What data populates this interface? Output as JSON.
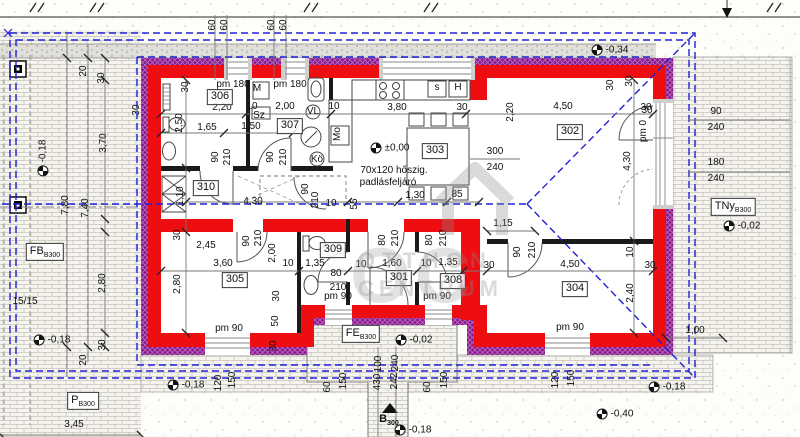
{
  "title": "Családi ház alaprajz (floor plan)",
  "colors": {
    "red": "#ee0d10",
    "insul": "#8a1690",
    "blue": "#2121d8",
    "black": "#1a1a1a",
    "dim": "#777777"
  },
  "note": {
    "line1": "70x120 hőszig.",
    "line2": "padlásfeljáró"
  },
  "watermark": {
    "big": "OC",
    "line1": "OTTHON",
    "line2": "CENTRUM"
  },
  "rooms": [
    {
      "t": "301",
      "x": 399,
      "y": 278
    },
    {
      "t": "302",
      "x": 570,
      "y": 132
    },
    {
      "t": "303",
      "x": 435,
      "y": 151
    },
    {
      "t": "304",
      "x": 575,
      "y": 289
    },
    {
      "t": "305",
      "x": 235,
      "y": 280
    },
    {
      "t": "306",
      "x": 220,
      "y": 97
    },
    {
      "t": "307",
      "x": 290,
      "y": 126
    },
    {
      "t": "308",
      "x": 453,
      "y": 281
    },
    {
      "t": "309",
      "x": 333,
      "y": 250
    },
    {
      "t": "310",
      "x": 206,
      "y": 188
    }
  ],
  "areas": [
    {
      "main": "FB",
      "sub": "B300",
      "x": 45,
      "y": 252
    },
    {
      "main": "P",
      "sub": "B300",
      "x": 83,
      "y": 401
    },
    {
      "main": "FE",
      "sub": "B300",
      "x": 361,
      "y": 334
    },
    {
      "main": "TNy",
      "sub": "B300",
      "x": 733,
      "y": 207
    },
    {
      "main": "B",
      "sub": "300",
      "x": 389,
      "y": 420,
      "cls": "plain"
    }
  ],
  "levels": [
    {
      "t": "-0,18",
      "x": 43,
      "y": 158,
      "r": -90
    },
    {
      "t": "-0,18",
      "x": 52,
      "y": 340
    },
    {
      "t": "-0,34",
      "x": 610,
      "y": 50
    },
    {
      "t": "±0,00",
      "x": 390,
      "y": 148
    },
    {
      "t": "-0,02",
      "x": 742,
      "y": 226
    },
    {
      "t": "-0,02",
      "x": 414,
      "y": 340
    },
    {
      "t": "-0,18",
      "x": 186,
      "y": 385
    },
    {
      "t": "-0,18",
      "x": 413,
      "y": 430
    },
    {
      "t": "-0,18",
      "x": 667,
      "y": 387
    },
    {
      "t": "-0,40",
      "x": 615,
      "y": 414
    }
  ],
  "dims": [
    {
      "t": "60",
      "x": 213,
      "y": 25,
      "r": -90
    },
    {
      "t": "60",
      "x": 225,
      "y": 25,
      "r": -90
    },
    {
      "t": "60",
      "x": 272,
      "y": 25,
      "r": -90
    },
    {
      "t": "60",
      "x": 284,
      "y": 25,
      "r": -90
    },
    {
      "t": "pm 180",
      "x": 233,
      "y": 85
    },
    {
      "t": "30",
      "x": 186,
      "y": 87,
      "r": -90
    },
    {
      "t": "2,20",
      "x": 222,
      "y": 108
    },
    {
      "t": "M",
      "x": 257,
      "y": 89
    },
    {
      "t": "pm 180",
      "x": 290,
      "y": 85
    },
    {
      "t": "10",
      "x": 252,
      "y": 107
    },
    {
      "t": "2,00",
      "x": 285,
      "y": 107
    },
    {
      "t": "Sz",
      "x": 259,
      "y": 116
    },
    {
      "t": "2,50",
      "x": 180,
      "y": 123,
      "r": -90
    },
    {
      "t": "1,65",
      "x": 207,
      "y": 128
    },
    {
      "t": "1,50",
      "x": 251,
      "y": 127
    },
    {
      "t": "90",
      "x": 216,
      "y": 157,
      "r": -90
    },
    {
      "t": "210",
      "x": 228,
      "y": 157,
      "r": -90
    },
    {
      "t": "90",
      "x": 271,
      "y": 157,
      "r": -90
    },
    {
      "t": "210",
      "x": 284,
      "y": 157,
      "r": -90
    },
    {
      "t": "VL",
      "x": 313,
      "y": 112
    },
    {
      "t": "Mo",
      "x": 338,
      "y": 134,
      "r": -90
    },
    {
      "t": "Kö",
      "x": 317,
      "y": 160
    },
    {
      "t": "10",
      "x": 334,
      "y": 107
    },
    {
      "t": "3,80",
      "x": 397,
      "y": 108
    },
    {
      "t": "30",
      "x": 462,
      "y": 108
    },
    {
      "t": "s",
      "x": 437,
      "y": 88
    },
    {
      "t": "H",
      "x": 458,
      "y": 88
    },
    {
      "t": "30",
      "x": 630,
      "y": 81,
      "r": -90
    },
    {
      "t": "2,20",
      "x": 511,
      "y": 112,
      "r": -90
    },
    {
      "t": "4,50",
      "x": 563,
      "y": 107
    },
    {
      "t": "30",
      "x": 646,
      "y": 108
    },
    {
      "t": "300",
      "x": 495,
      "y": 152
    },
    {
      "t": "240",
      "x": 495,
      "y": 168
    },
    {
      "t": "1,30",
      "x": 415,
      "y": 196
    },
    {
      "t": "85",
      "x": 457,
      "y": 195
    },
    {
      "t": "55",
      "x": 355,
      "y": 204,
      "r": -90
    },
    {
      "t": "4,30",
      "x": 253,
      "y": 202
    },
    {
      "t": "1,10",
      "x": 181,
      "y": 196,
      "r": -90
    },
    {
      "t": "90",
      "x": 306,
      "y": 189,
      "r": -90
    },
    {
      "t": "210",
      "x": 316,
      "y": 200,
      "r": -90
    },
    {
      "t": "10",
      "x": 331,
      "y": 204
    },
    {
      "t": "30",
      "x": 178,
      "y": 235,
      "r": -90
    },
    {
      "t": "2,45",
      "x": 206,
      "y": 246
    },
    {
      "t": "90",
      "x": 247,
      "y": 241,
      "r": -90
    },
    {
      "t": "210",
      "x": 259,
      "y": 238,
      "r": -90
    },
    {
      "t": "2,00",
      "x": 273,
      "y": 253,
      "r": -90
    },
    {
      "t": "3,60",
      "x": 223,
      "y": 264
    },
    {
      "t": "10",
      "x": 288,
      "y": 264
    },
    {
      "t": "2,80",
      "x": 178,
      "y": 284,
      "r": -90
    },
    {
      "t": "30",
      "x": 277,
      "y": 296,
      "r": -90
    },
    {
      "t": "50",
      "x": 276,
      "y": 321,
      "r": -90
    },
    {
      "t": "30",
      "x": 274,
      "y": 346,
      "r": -90
    },
    {
      "t": "pm 90",
      "x": 229,
      "y": 329
    },
    {
      "t": "pm 90",
      "x": 338,
      "y": 297
    },
    {
      "t": "pm 90",
      "x": 437,
      "y": 297
    },
    {
      "t": "pm 90",
      "x": 570,
      "y": 328
    },
    {
      "t": "1,35",
      "x": 315,
      "y": 264
    },
    {
      "t": "80",
      "x": 336,
      "y": 274
    },
    {
      "t": "210",
      "x": 338,
      "y": 288
    },
    {
      "t": "10",
      "x": 361,
      "y": 265
    },
    {
      "t": "1,60",
      "x": 392,
      "y": 264
    },
    {
      "t": "10",
      "x": 426,
      "y": 264
    },
    {
      "t": "1,35",
      "x": 448,
      "y": 263
    },
    {
      "t": "30",
      "x": 489,
      "y": 266
    },
    {
      "t": "80",
      "x": 383,
      "y": 240,
      "r": -90
    },
    {
      "t": "210",
      "x": 396,
      "y": 238,
      "r": -90
    },
    {
      "t": "80",
      "x": 430,
      "y": 240,
      "r": -90
    },
    {
      "t": "210",
      "x": 444,
      "y": 238,
      "r": -90
    },
    {
      "t": "1,15",
      "x": 503,
      "y": 224
    },
    {
      "t": "90",
      "x": 518,
      "y": 252,
      "r": -90
    },
    {
      "t": "210",
      "x": 533,
      "y": 250,
      "r": -90
    },
    {
      "t": "4,50",
      "x": 570,
      "y": 265
    },
    {
      "t": "30",
      "x": 650,
      "y": 266
    },
    {
      "t": "10",
      "x": 631,
      "y": 252,
      "r": -90
    },
    {
      "t": "2,40",
      "x": 631,
      "y": 293,
      "r": -90
    },
    {
      "t": "30",
      "x": 137,
      "y": 110,
      "r": -90
    },
    {
      "t": "30",
      "x": 611,
      "y": 85,
      "r": -90
    },
    {
      "t": "30",
      "x": 647,
      "y": 111
    },
    {
      "t": "pm 0",
      "x": 644,
      "y": 131,
      "r": -90
    },
    {
      "t": "90",
      "x": 716,
      "y": 112
    },
    {
      "t": "240",
      "x": 716,
      "y": 128
    },
    {
      "t": "180",
      "x": 716,
      "y": 163
    },
    {
      "t": "240",
      "x": 716,
      "y": 179
    },
    {
      "t": "4,30",
      "x": 628,
      "y": 161,
      "r": -90
    },
    {
      "t": "1,00",
      "x": 695,
      "y": 331
    },
    {
      "t": "20",
      "x": 84,
      "y": 71,
      "r": -90
    },
    {
      "t": "30",
      "x": 102,
      "y": 78,
      "r": -90
    },
    {
      "t": "3,70",
      "x": 104,
      "y": 143,
      "r": -90
    },
    {
      "t": "7,80",
      "x": 66,
      "y": 205,
      "r": -90
    },
    {
      "t": "7,40",
      "x": 86,
      "y": 208,
      "r": -90
    },
    {
      "t": "2,80",
      "x": 103,
      "y": 283,
      "r": -90
    },
    {
      "t": "30",
      "x": 103,
      "y": 345,
      "r": -90
    },
    {
      "t": "20",
      "x": 84,
      "y": 360,
      "r": -90
    },
    {
      "t": "15/15",
      "x": 25,
      "y": 302
    },
    {
      "t": "3,45",
      "x": 74,
      "y": 425
    },
    {
      "t": "120",
      "x": 219,
      "y": 383,
      "r": -90
    },
    {
      "t": "150",
      "x": 233,
      "y": 380,
      "r": -90
    },
    {
      "t": "60",
      "x": 328,
      "y": 387,
      "r": -90
    },
    {
      "t": "150",
      "x": 344,
      "y": 381,
      "r": -90
    },
    {
      "t": "430",
      "x": 378,
      "y": 382,
      "r": -90
    },
    {
      "t": "100",
      "x": 379,
      "y": 364,
      "r": -90
    },
    {
      "t": "242",
      "x": 395,
      "y": 381,
      "r": -90
    },
    {
      "t": "240",
      "x": 396,
      "y": 363,
      "r": -90
    },
    {
      "t": "60",
      "x": 428,
      "y": 387,
      "r": -90
    },
    {
      "t": "150",
      "x": 445,
      "y": 380,
      "r": -90
    },
    {
      "t": "120",
      "x": 556,
      "y": 380,
      "r": -90
    },
    {
      "t": "150",
      "x": 572,
      "y": 378,
      "r": -90
    }
  ],
  "notes": [
    {
      "t": "70x120 hőszig.",
      "x": 394,
      "y": 171
    },
    {
      "t": "padlásfeljáró",
      "x": 388,
      "y": 183
    }
  ]
}
